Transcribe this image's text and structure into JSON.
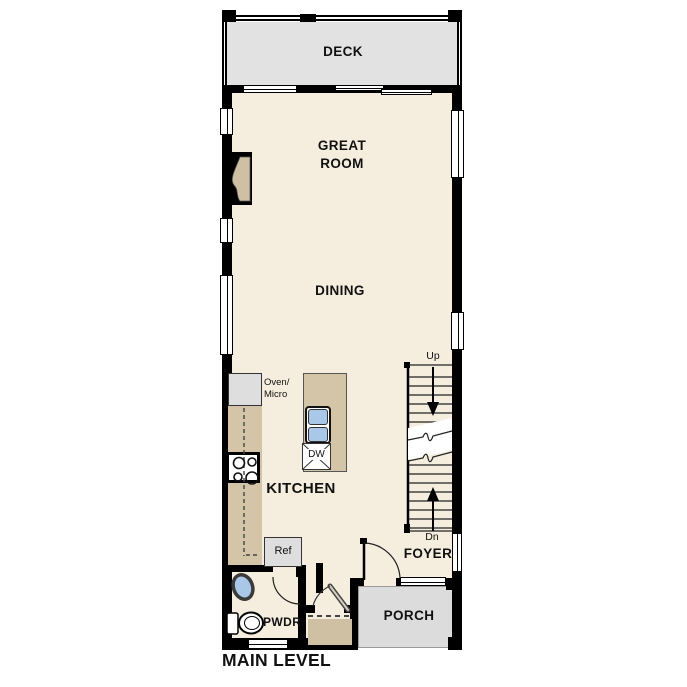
{
  "plan_title": "MAIN LEVEL",
  "rooms": {
    "deck": "DECK",
    "great_room": "GREAT\nROOM",
    "dining": "DINING",
    "kitchen": "KITCHEN",
    "foyer": "FOYER",
    "porch": "PORCH",
    "powder": "PWDR"
  },
  "fixtures": {
    "oven_micro": "Oven/\nMicro",
    "dishwasher": "DW",
    "refrigerator": "Ref"
  },
  "stairs": {
    "up_label": "Up",
    "down_label": "Dn"
  },
  "colors": {
    "wall": "#000000",
    "floor": "#f5eede",
    "deck_porch": "#e0e0e0",
    "counter": "#d4c5a8",
    "sink": "#a9c7e6"
  }
}
